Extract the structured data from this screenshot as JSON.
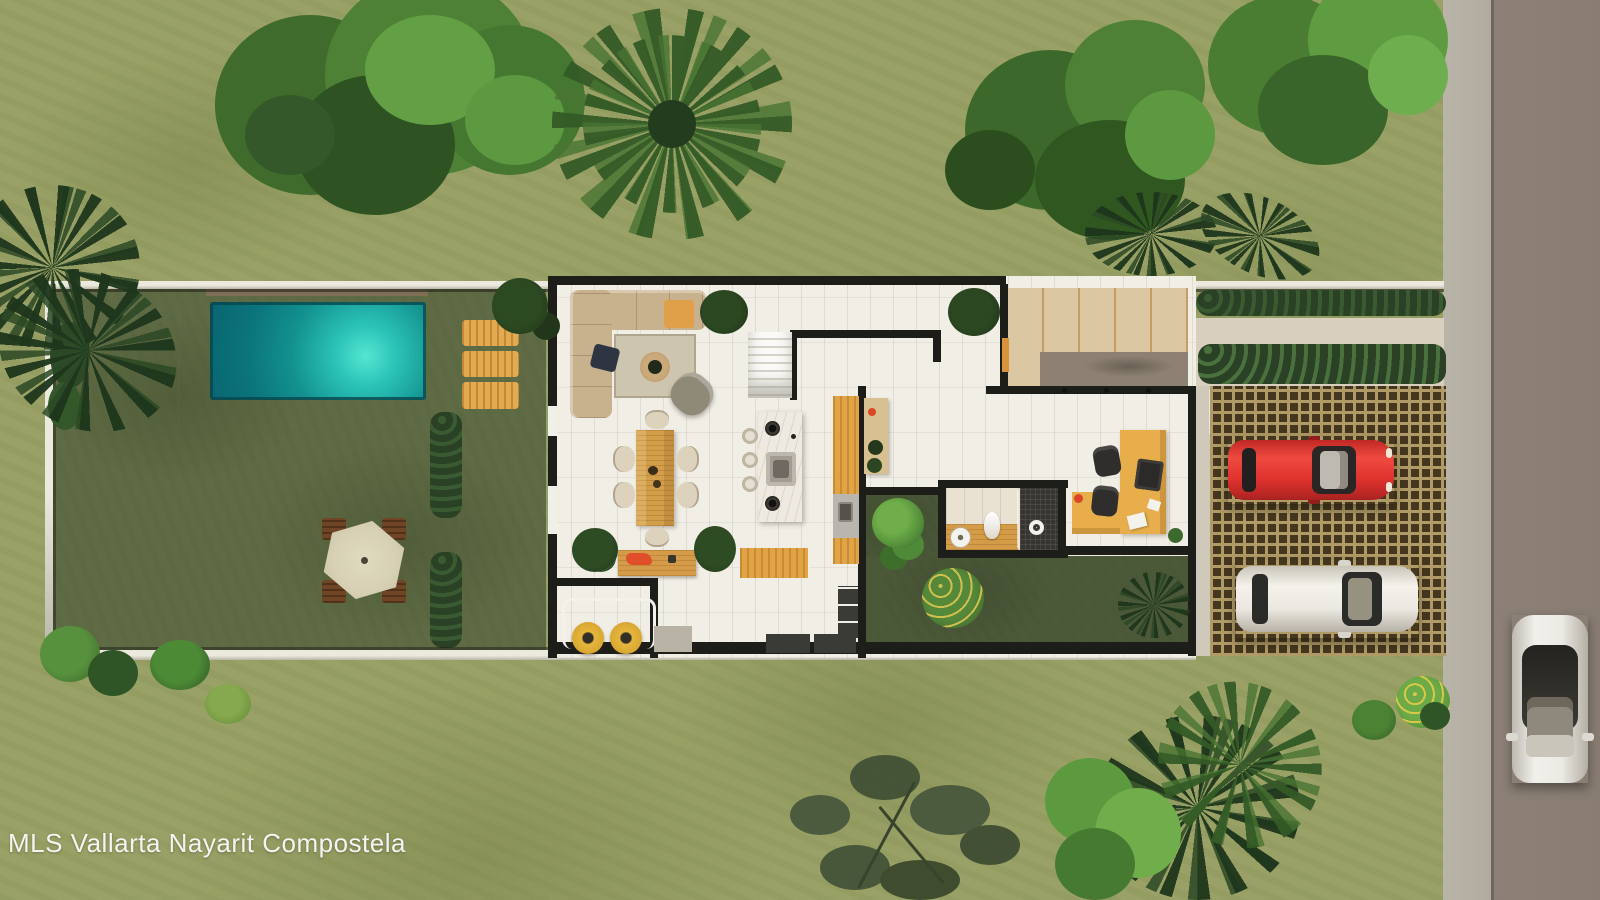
{
  "watermark": {
    "text": "MLS Vallarta Nayarit Compostela"
  },
  "scene": {
    "description": "Top-down 3D architectural rendering of a narrow-lot single-story villa with walled garden, pool and driveway beside a street",
    "rooms": [
      "living room",
      "staircase",
      "dining room",
      "kitchen",
      "laundry",
      "rear terrace",
      "hallway",
      "bathroom",
      "home office",
      "inner courtyard",
      "entry patio"
    ],
    "exterior_features": [
      "walled back garden",
      "swimming pool",
      "pool deck",
      "sun loungers",
      "patio umbrella with benches",
      "privacy hedges",
      "lattice paver driveway",
      "entry concrete pad",
      "sidewalk",
      "street"
    ],
    "vehicles": [
      "red car in driveway",
      "white car in driveway",
      "white car on street"
    ],
    "counts": {
      "sun_loungers": 3,
      "dining_chairs": 6,
      "bar_stools": 3,
      "umbrella_benches": 4,
      "laundry_machines": 2,
      "cars_in_driveway": 2,
      "cars_on_street": 1,
      "door_pivots": 3
    }
  },
  "colors": {
    "outer_lawn": "#99a166",
    "garden_lawn": "#5f6b44",
    "courtyard_lawn": "#4c5939",
    "pool_water_deep": "#0b747c",
    "pool_water_glow": "#55e6d2",
    "pool_deck": "#d6d0c2",
    "house_floor": "#f1eee6",
    "wall_dark": "#1d1d1a",
    "site_wall": "#ece9df",
    "wood_furniture": "#d49c48",
    "cabinet_wood": "#e2a344",
    "entry_concrete": "#dcc7a3",
    "entry_mat": "#8d8173",
    "driveway_cell": "#45371f",
    "driveway_grout": "#b09a66",
    "road": "#8d8177",
    "sidewalk": "#b5b0a4",
    "car_red": "#e0332e",
    "car_white": "#ebe8e1",
    "hedge": "#2a4126",
    "tree_green": "#4e8136",
    "palm_dark": "#2b482b",
    "umbrella": "#d7d0b4",
    "lounger": "#e3aa50",
    "laundry_machine": "#e6b63c"
  }
}
